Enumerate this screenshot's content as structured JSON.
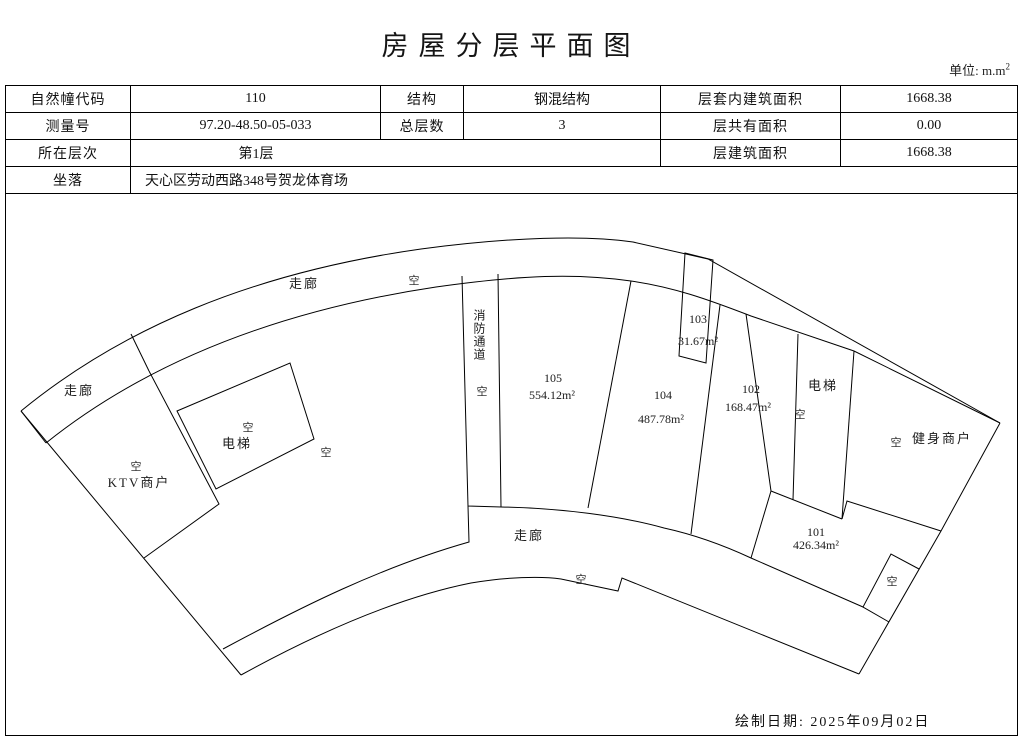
{
  "page": {
    "title": "房屋分层平面图",
    "unit_label": "单位: m.m",
    "unit_sup": "2",
    "date_label": "绘制日期: 2025年09月02日"
  },
  "table": {
    "r1c1": "自然幢代码",
    "r1c2": "110",
    "r1c3": "结构",
    "r1c4": "钢混结构",
    "r1c5": "层套内建筑面积",
    "r1c6": "1668.38",
    "r2c1": "测量号",
    "r2c2": "97.20-48.50-05-033",
    "r2c3": "总层数",
    "r2c4": "3",
    "r2c5": "层共有面积",
    "r2c6": "0.00",
    "r3c1": "所在层次",
    "r3c2": "第1层",
    "r3c5": "层建筑面积",
    "r3c6": "1668.38",
    "r4c1": "坐落",
    "r4c2": "天心区劳动西路348号贺龙体育场"
  },
  "plan": {
    "corridor_top": "走廊",
    "corridor_left": "走廊",
    "corridor_bottom": "走廊",
    "fire_passage": "消防通道",
    "void1": "空",
    "void2": "空",
    "void3": "空",
    "void4": "空",
    "void5": "空",
    "void6": "空",
    "void7": "空",
    "void8": "空",
    "void9": "空",
    "room105_no": "105",
    "room105_area": "554.12m²",
    "room104_no": "104",
    "room104_area": "487.78m²",
    "room103_no": "103",
    "room103_area": "31.67m²",
    "room102_no": "102",
    "room102_area": "168.47m²",
    "room101_no": "101",
    "room101_area": "426.34m²",
    "lift_left": "电梯",
    "lift_right": "电梯",
    "ktv": "KTV商户",
    "gym": "健身商户"
  }
}
